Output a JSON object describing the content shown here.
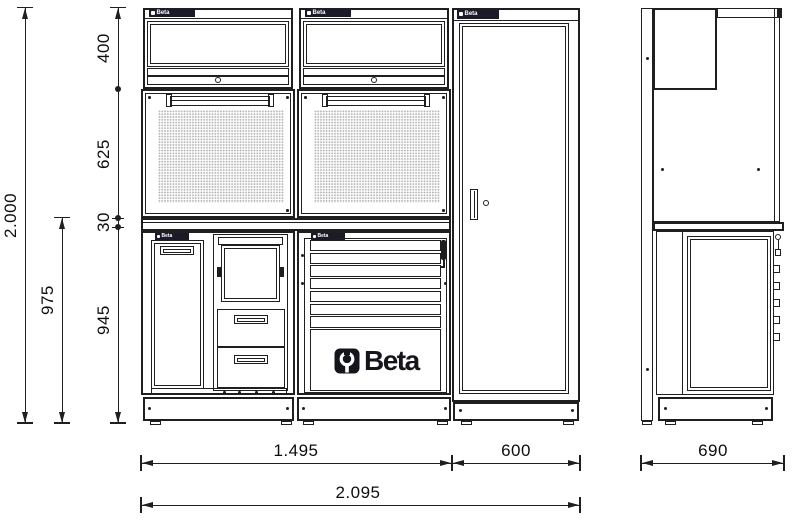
{
  "brand": {
    "name": "Beta"
  },
  "dimensions": {
    "total_height": "2.000",
    "wall_unit_height": "400",
    "tool_panel_height": "625",
    "worktop_thickness": "30",
    "worktop_height": "975",
    "base_unit_height": "945",
    "workbench_width": "1.495",
    "tall_cabinet_width": "600",
    "total_width": "2.095",
    "depth": "690"
  }
}
